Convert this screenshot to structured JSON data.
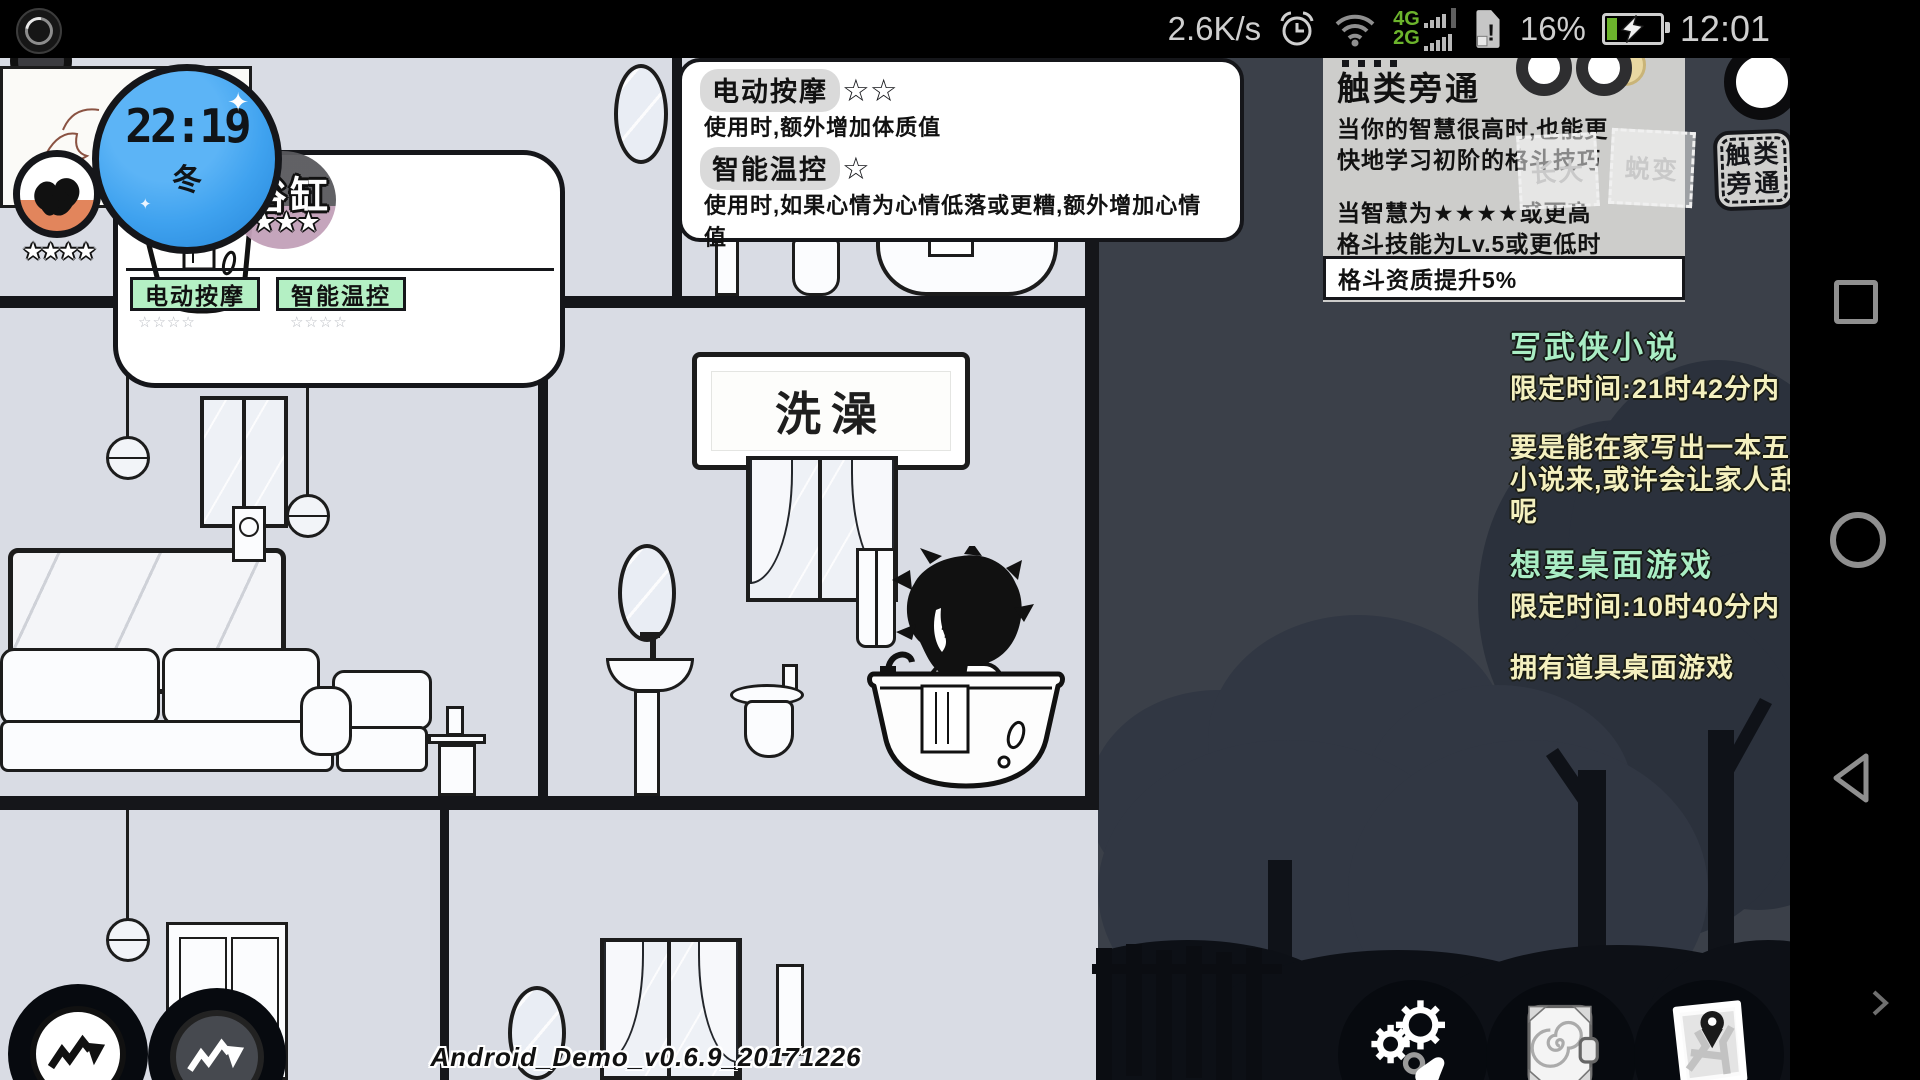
{
  "status_bar": {
    "net_speed": "2.6K/s",
    "net_4g": "4G",
    "net_2g": "2G",
    "sim_alert": "!",
    "battery_percent": "16%",
    "time": "12:01"
  },
  "hud": {
    "clock_time": "22:19",
    "clock_season": "冬",
    "sparkle": "✦",
    "strength_stars": "★★★★"
  },
  "bathtub_panel": {
    "title": "浴缸",
    "stars": "★★★",
    "tag_massage": "电动按摩",
    "tag_thermo": "智能温控",
    "ghost_stars": "☆☆☆☆"
  },
  "effects_tooltip": {
    "massage_name": "电动按摩",
    "massage_stars": "☆☆",
    "massage_desc": "使用时,额外增加体质值",
    "thermo_name": "智能温控",
    "thermo_stars": "☆",
    "thermo_desc": "使用时,如果心情为心情低落或更糟,额外增加心情值"
  },
  "skill_panel": {
    "title": "触类旁通",
    "desc_line1": "当你的智慧很高时,也能更",
    "desc_line2": "快地学习初阶的格斗技巧",
    "cond_line1": "当智慧为★★★★或更高",
    "cond_line2": "格斗技能为Lv.5或更低时",
    "cond_line3": "格斗资质提升5%",
    "ghost_stamp1": "长大",
    "ghost_stamp2": "蜕变",
    "stamp_line1": "触类",
    "stamp_line2": "旁通"
  },
  "quests": {
    "q1_title": "写武侠小说",
    "q1_time": "限定时间:21时42分内",
    "q1_desc1": "要是能在家写出一本五",
    "q1_desc2": "小说来,或许会让家人刮",
    "q1_desc3": "呢",
    "q2_title": "想要桌面游戏",
    "q2_time": "限定时间:10时40分内",
    "q2_desc1": "拥有道具桌面游戏"
  },
  "scene": {
    "bath_sign": "洗澡"
  },
  "version_text": "Android_Demo_v0.6.9_20171226",
  "colors": {
    "status_green": "#6cb42c",
    "quest_title_green": "#a9edc4",
    "quest_text_cream": "#f4f0bf",
    "tag_green": "#b4f0c4",
    "clock_blue": "#3fa2ef",
    "night_bg": "#3b4049",
    "interior_bg": "#d9dce4",
    "stat_gauge_orange": "#e2855c",
    "badge_gauge_pink": "#c2a0b8"
  }
}
